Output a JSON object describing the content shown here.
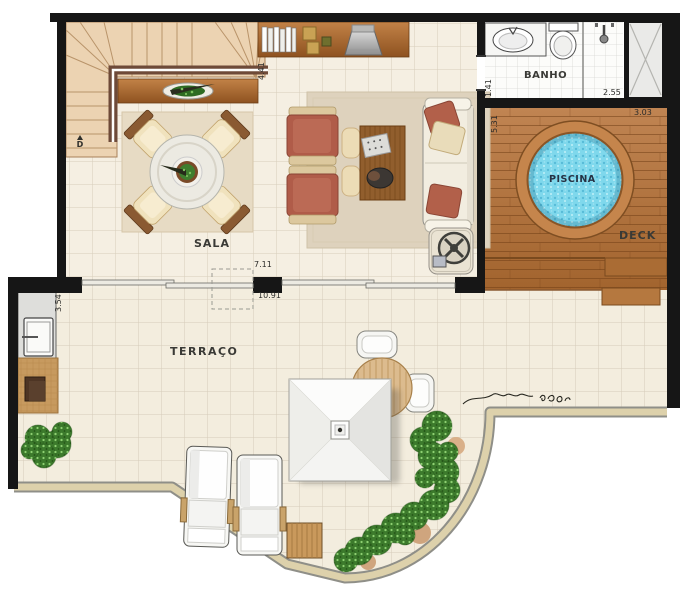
{
  "rooms": {
    "sala": {
      "label": "SALA"
    },
    "banho": {
      "label": "BANHO"
    },
    "piscina": {
      "label": "PISCINA"
    },
    "deck": {
      "label": "DECK"
    },
    "terraco": {
      "label": "TERRAÇO"
    }
  },
  "dims": {
    "stairs_side": "4.41",
    "banho_door_side": "1.41",
    "banho_width": "2.55",
    "deck_side": "5.31",
    "deck_top": "3.03",
    "kitchen_side": "3.54",
    "sala_opening": "7.11",
    "terrace_span": "10.91"
  },
  "stairs": {
    "direction_marker": "D"
  },
  "colors": {
    "wall": "#161616",
    "floor": "#f5efe2",
    "stairs": "#ecd3b2",
    "wood_furniture": "#a9601f",
    "deck": "#b5783f",
    "pool_water": "#7fd8ec",
    "rust_upholstery": "#b05c49",
    "hedge_green": "#3c7a2c",
    "parapet_sand": "#ddd1ab"
  }
}
